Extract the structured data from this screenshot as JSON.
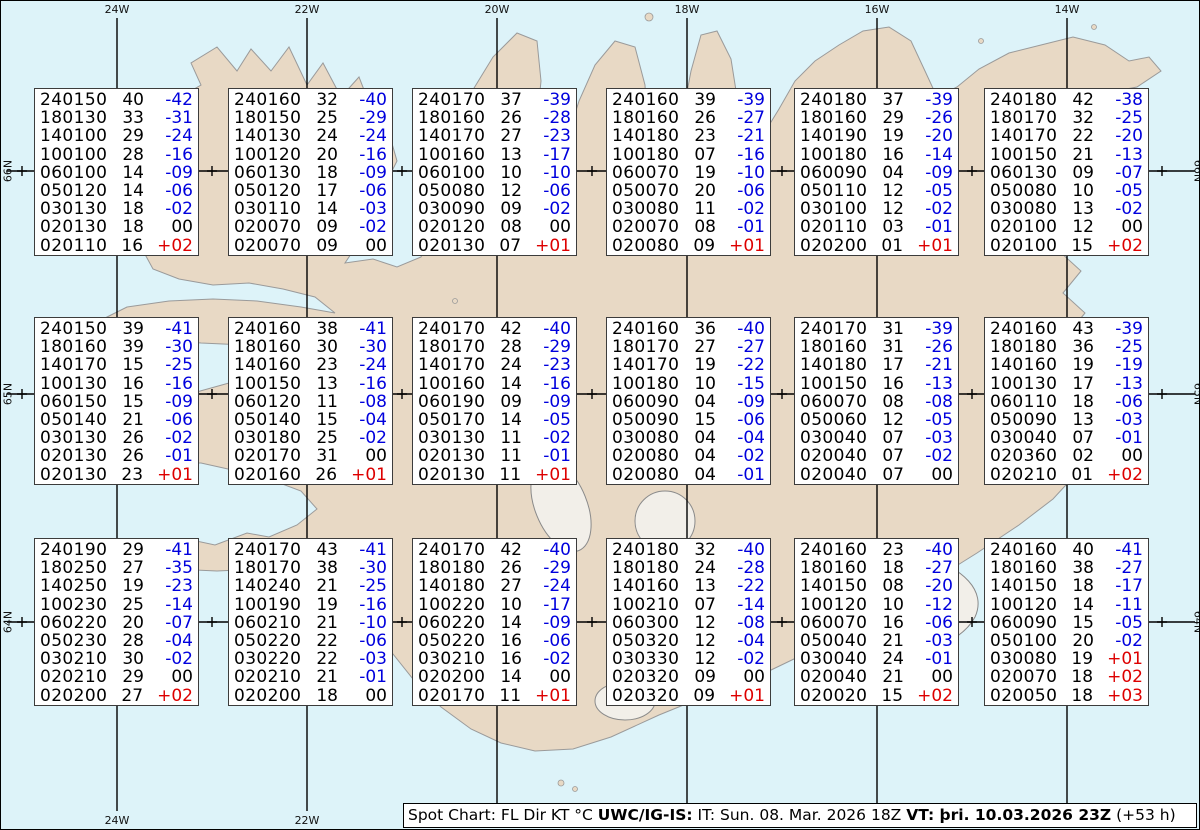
{
  "title": "Spot Chart",
  "chart_data": {
    "type": "table",
    "columns_legend": "FL Dir KT °C",
    "stations": [
      {
        "grid": "r1c1",
        "levels": [
          [
            "240150",
            "40",
            "-42"
          ],
          [
            "180130",
            "33",
            "-31"
          ],
          [
            "140100",
            "29",
            "-24"
          ],
          [
            "100100",
            "28",
            "-16"
          ],
          [
            "060100",
            "14",
            "-09"
          ],
          [
            "050120",
            "14",
            "-06"
          ],
          [
            "030130",
            "18",
            "-02"
          ],
          [
            "020130",
            "18",
            "00"
          ],
          [
            "020110",
            "16",
            "+02"
          ]
        ]
      },
      {
        "grid": "r1c2",
        "levels": [
          [
            "240160",
            "32",
            "-40"
          ],
          [
            "180150",
            "25",
            "-29"
          ],
          [
            "140130",
            "24",
            "-24"
          ],
          [
            "100120",
            "20",
            "-16"
          ],
          [
            "060130",
            "18",
            "-09"
          ],
          [
            "050120",
            "17",
            "-06"
          ],
          [
            "030110",
            "14",
            "-03"
          ],
          [
            "020070",
            "09",
            "-02"
          ],
          [
            "020070",
            "09",
            "00"
          ]
        ]
      },
      {
        "grid": "r1c3",
        "levels": [
          [
            "240170",
            "37",
            "-39"
          ],
          [
            "180160",
            "26",
            "-28"
          ],
          [
            "140170",
            "27",
            "-23"
          ],
          [
            "100160",
            "13",
            "-17"
          ],
          [
            "060100",
            "10",
            "-10"
          ],
          [
            "050080",
            "12",
            "-06"
          ],
          [
            "030090",
            "09",
            "-02"
          ],
          [
            "020120",
            "08",
            "00"
          ],
          [
            "020130",
            "07",
            "+01"
          ]
        ]
      },
      {
        "grid": "r1c4",
        "levels": [
          [
            "240160",
            "39",
            "-39"
          ],
          [
            "180160",
            "26",
            "-27"
          ],
          [
            "140180",
            "23",
            "-21"
          ],
          [
            "100180",
            "07",
            "-16"
          ],
          [
            "060070",
            "19",
            "-10"
          ],
          [
            "050070",
            "20",
            "-06"
          ],
          [
            "030080",
            "11",
            "-02"
          ],
          [
            "020070",
            "08",
            "-01"
          ],
          [
            "020080",
            "09",
            "+01"
          ]
        ]
      },
      {
        "grid": "r1c5",
        "levels": [
          [
            "240180",
            "37",
            "-39"
          ],
          [
            "180160",
            "29",
            "-26"
          ],
          [
            "140190",
            "19",
            "-20"
          ],
          [
            "100180",
            "16",
            "-14"
          ],
          [
            "060090",
            "04",
            "-09"
          ],
          [
            "050110",
            "12",
            "-05"
          ],
          [
            "030100",
            "12",
            "-02"
          ],
          [
            "020110",
            "03",
            "-01"
          ],
          [
            "020200",
            "01",
            "+01"
          ]
        ]
      },
      {
        "grid": "r1c6",
        "levels": [
          [
            "240180",
            "42",
            "-38"
          ],
          [
            "180170",
            "32",
            "-25"
          ],
          [
            "140170",
            "22",
            "-20"
          ],
          [
            "100150",
            "21",
            "-13"
          ],
          [
            "060130",
            "09",
            "-07"
          ],
          [
            "050080",
            "10",
            "-05"
          ],
          [
            "030080",
            "13",
            "-02"
          ],
          [
            "020100",
            "12",
            "00"
          ],
          [
            "020100",
            "15",
            "+02"
          ]
        ]
      },
      {
        "grid": "r2c1",
        "levels": [
          [
            "240150",
            "39",
            "-41"
          ],
          [
            "180160",
            "39",
            "-30"
          ],
          [
            "140170",
            "15",
            "-25"
          ],
          [
            "100130",
            "16",
            "-16"
          ],
          [
            "060150",
            "15",
            "-09"
          ],
          [
            "050140",
            "21",
            "-06"
          ],
          [
            "030130",
            "26",
            "-02"
          ],
          [
            "020130",
            "26",
            "-01"
          ],
          [
            "020130",
            "23",
            "+01"
          ]
        ]
      },
      {
        "grid": "r2c2",
        "levels": [
          [
            "240160",
            "38",
            "-41"
          ],
          [
            "180160",
            "30",
            "-30"
          ],
          [
            "140160",
            "23",
            "-24"
          ],
          [
            "100150",
            "13",
            "-16"
          ],
          [
            "060120",
            "11",
            "-08"
          ],
          [
            "050140",
            "15",
            "-04"
          ],
          [
            "030180",
            "25",
            "-02"
          ],
          [
            "020170",
            "31",
            "00"
          ],
          [
            "020160",
            "26",
            "+01"
          ]
        ]
      },
      {
        "grid": "r2c3",
        "levels": [
          [
            "240170",
            "42",
            "-40"
          ],
          [
            "180170",
            "28",
            "-29"
          ],
          [
            "140170",
            "24",
            "-23"
          ],
          [
            "100160",
            "14",
            "-16"
          ],
          [
            "060190",
            "09",
            "-09"
          ],
          [
            "050170",
            "14",
            "-05"
          ],
          [
            "030130",
            "11",
            "-02"
          ],
          [
            "020130",
            "11",
            "-01"
          ],
          [
            "020130",
            "11",
            "+01"
          ]
        ]
      },
      {
        "grid": "r2c4",
        "levels": [
          [
            "240160",
            "36",
            "-40"
          ],
          [
            "180170",
            "27",
            "-27"
          ],
          [
            "140170",
            "19",
            "-22"
          ],
          [
            "100180",
            "10",
            "-15"
          ],
          [
            "060090",
            "04",
            "-09"
          ],
          [
            "050090",
            "15",
            "-06"
          ],
          [
            "030080",
            "04",
            "-04"
          ],
          [
            "020080",
            "04",
            "-02"
          ],
          [
            "020080",
            "04",
            "-01"
          ]
        ]
      },
      {
        "grid": "r2c5",
        "levels": [
          [
            "240170",
            "31",
            "-39"
          ],
          [
            "180160",
            "31",
            "-26"
          ],
          [
            "140180",
            "17",
            "-21"
          ],
          [
            "100150",
            "16",
            "-13"
          ],
          [
            "060070",
            "08",
            "-08"
          ],
          [
            "050060",
            "12",
            "-05"
          ],
          [
            "030040",
            "07",
            "-03"
          ],
          [
            "020040",
            "07",
            "-02"
          ],
          [
            "020040",
            "07",
            "00"
          ]
        ]
      },
      {
        "grid": "r2c6",
        "levels": [
          [
            "240160",
            "43",
            "-39"
          ],
          [
            "180180",
            "36",
            "-25"
          ],
          [
            "140160",
            "19",
            "-19"
          ],
          [
            "100130",
            "17",
            "-13"
          ],
          [
            "060110",
            "18",
            "-06"
          ],
          [
            "050090",
            "13",
            "-03"
          ],
          [
            "030040",
            "07",
            "-01"
          ],
          [
            "020360",
            "02",
            "00"
          ],
          [
            "020210",
            "01",
            "+02"
          ]
        ]
      },
      {
        "grid": "r3c1",
        "levels": [
          [
            "240190",
            "29",
            "-41"
          ],
          [
            "180250",
            "27",
            "-35"
          ],
          [
            "140250",
            "19",
            "-23"
          ],
          [
            "100230",
            "25",
            "-14"
          ],
          [
            "060220",
            "20",
            "-07"
          ],
          [
            "050230",
            "28",
            "-04"
          ],
          [
            "030210",
            "30",
            "-02"
          ],
          [
            "020210",
            "29",
            "00"
          ],
          [
            "020200",
            "27",
            "+02"
          ]
        ]
      },
      {
        "grid": "r3c2",
        "levels": [
          [
            "240170",
            "43",
            "-41"
          ],
          [
            "180170",
            "38",
            "-30"
          ],
          [
            "140240",
            "21",
            "-25"
          ],
          [
            "100190",
            "19",
            "-16"
          ],
          [
            "060210",
            "21",
            "-10"
          ],
          [
            "050220",
            "22",
            "-06"
          ],
          [
            "030220",
            "22",
            "-03"
          ],
          [
            "020210",
            "21",
            "-01"
          ],
          [
            "020200",
            "18",
            "00"
          ]
        ]
      },
      {
        "grid": "r3c3",
        "levels": [
          [
            "240170",
            "42",
            "-40"
          ],
          [
            "180180",
            "26",
            "-29"
          ],
          [
            "140180",
            "27",
            "-24"
          ],
          [
            "100220",
            "10",
            "-17"
          ],
          [
            "060220",
            "14",
            "-09"
          ],
          [
            "050220",
            "16",
            "-06"
          ],
          [
            "030210",
            "16",
            "-02"
          ],
          [
            "020200",
            "14",
            "00"
          ],
          [
            "020170",
            "11",
            "+01"
          ]
        ]
      },
      {
        "grid": "r3c4",
        "levels": [
          [
            "240180",
            "32",
            "-40"
          ],
          [
            "180180",
            "24",
            "-28"
          ],
          [
            "140160",
            "13",
            "-22"
          ],
          [
            "100210",
            "07",
            "-14"
          ],
          [
            "060300",
            "12",
            "-08"
          ],
          [
            "050320",
            "12",
            "-04"
          ],
          [
            "030330",
            "12",
            "-02"
          ],
          [
            "020320",
            "09",
            "00"
          ],
          [
            "020320",
            "09",
            "+01"
          ]
        ]
      },
      {
        "grid": "r3c5",
        "levels": [
          [
            "240160",
            "23",
            "-40"
          ],
          [
            "180160",
            "18",
            "-27"
          ],
          [
            "140150",
            "08",
            "-20"
          ],
          [
            "100120",
            "10",
            "-12"
          ],
          [
            "060070",
            "16",
            "-06"
          ],
          [
            "050040",
            "21",
            "-03"
          ],
          [
            "030040",
            "24",
            "-01"
          ],
          [
            "020040",
            "21",
            "00"
          ],
          [
            "020020",
            "15",
            "+02"
          ]
        ]
      },
      {
        "grid": "r3c6",
        "levels": [
          [
            "240160",
            "40",
            "-41"
          ],
          [
            "180160",
            "38",
            "-27"
          ],
          [
            "140150",
            "18",
            "-17"
          ],
          [
            "100120",
            "14",
            "-11"
          ],
          [
            "060090",
            "15",
            "-05"
          ],
          [
            "050100",
            "20",
            "-02"
          ],
          [
            "030080",
            "19",
            "+01"
          ],
          [
            "020070",
            "18",
            "+02"
          ],
          [
            "020050",
            "18",
            "+03"
          ]
        ]
      }
    ]
  },
  "graticule": {
    "meridians": [
      "24W",
      "22W",
      "20W",
      "18W",
      "16W",
      "14W"
    ],
    "parallels": [
      "66N",
      "65N",
      "64N"
    ]
  },
  "caption": {
    "product": "Spot Chart: FL Dir KT °C ",
    "center": "UWC/IG-IS:",
    "issue": " IT: Sun. 08. Mar. 2026 18Z ",
    "valid": "VT: þri. 10.03.2026 23Z",
    "lead": " (+53 h)"
  },
  "colors": {
    "ocean": "#ddf3f9",
    "land": "#e8d9c5",
    "coast": "#9a9a9a",
    "temp_negative": "#0000dd",
    "temp_positive": "#dd0000",
    "temp_zero": "#000000"
  }
}
